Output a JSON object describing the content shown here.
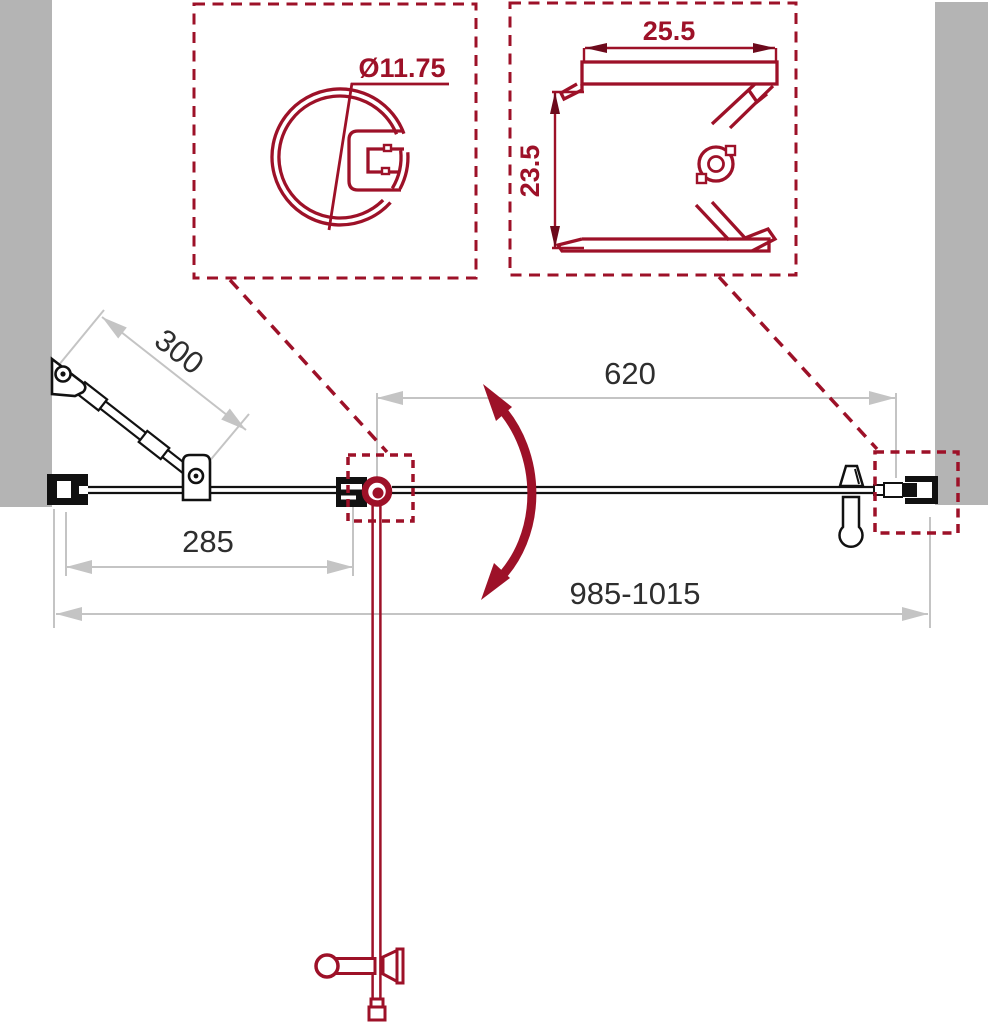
{
  "title": "shower-door-installation-drawing",
  "dimensions": {
    "support_bar_length": "300",
    "door_width": "620",
    "fixed_panel_width": "285",
    "total_width_range": "985-1015"
  },
  "details": {
    "hinge_profile_diameter": "Ø11.75",
    "wall_profile_width": "25.5",
    "wall_profile_height": "23.5"
  },
  "colors": {
    "drawing_red": "#9d1128",
    "wall_gray": "#b4b4b4",
    "dimension_gray": "#c4c4c4",
    "line_black": "#111111",
    "text_dark": "#2e2e2e"
  }
}
